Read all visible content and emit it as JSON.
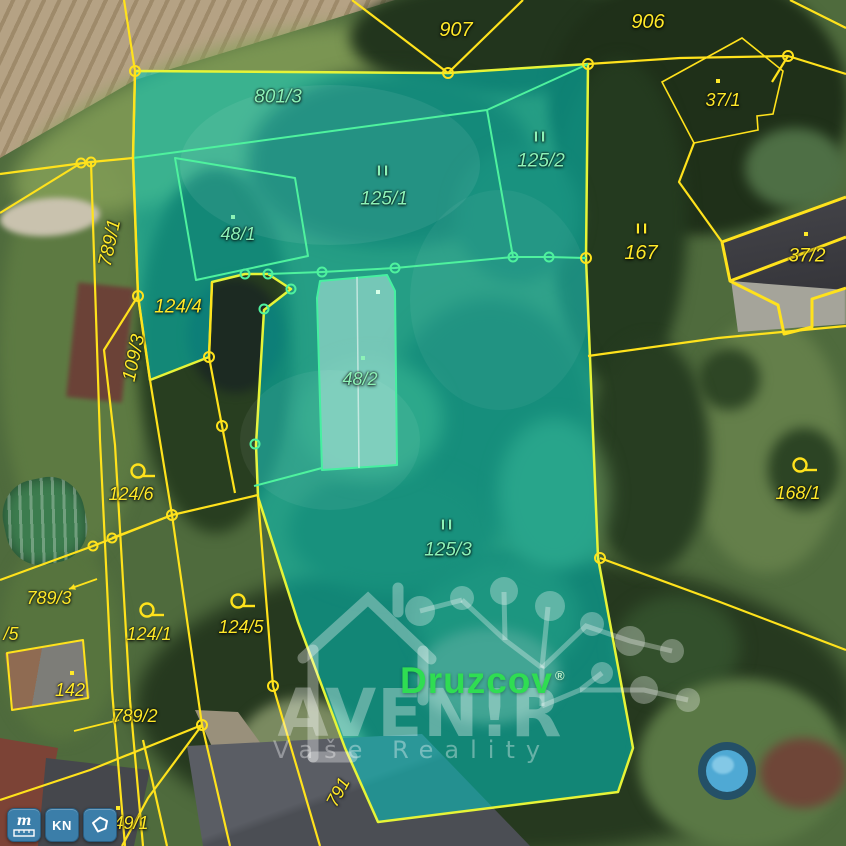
{
  "map": {
    "colors": {
      "highlight_fill": "#00cec7",
      "highlight_border": "#e6f437",
      "cadastre_yellow": "#ffe21c",
      "inner_parcel_green": "#4ef29e",
      "label_yellow": "#ffe929",
      "label_green": "#8df2b7",
      "druzcov_green": "#2fdd52",
      "button_blue": "#3b7ea9"
    },
    "parcel_labels": [
      {
        "text": "907",
        "x": 456,
        "y": 30,
        "color": "yellow",
        "fs": 20
      },
      {
        "text": "906",
        "x": 648,
        "y": 22,
        "color": "yellow",
        "fs": 20
      },
      {
        "text": "37/1",
        "x": 723,
        "y": 100,
        "color": "yellow",
        "fs": 18
      },
      {
        "text": "II",
        "x": 643,
        "y": 229,
        "color": "yellow",
        "fs": 15,
        "marker": true
      },
      {
        "text": "167",
        "x": 641,
        "y": 253,
        "color": "yellow",
        "fs": 20
      },
      {
        "text": "37/2",
        "x": 807,
        "y": 256,
        "color": "yellow",
        "fs": 19
      },
      {
        "text": "168/1",
        "x": 798,
        "y": 493,
        "color": "yellow",
        "fs": 18
      },
      {
        "text": "789/1",
        "x": 110,
        "y": 243,
        "color": "yellow",
        "fs": 19,
        "rot": -78
      },
      {
        "text": "109/3",
        "x": 134,
        "y": 358,
        "color": "yellow",
        "fs": 19,
        "rot": -78
      },
      {
        "text": "124/4",
        "x": 178,
        "y": 307,
        "color": "yellow",
        "fs": 19
      },
      {
        "text": "124/6",
        "x": 131,
        "y": 494,
        "color": "yellow",
        "fs": 18
      },
      {
        "text": "789/3",
        "x": 49,
        "y": 598,
        "color": "yellow",
        "fs": 18
      },
      {
        "text": "/5",
        "x": 11,
        "y": 634,
        "color": "yellow",
        "fs": 18
      },
      {
        "text": "124/1",
        "x": 149,
        "y": 634,
        "color": "yellow",
        "fs": 18
      },
      {
        "text": "142",
        "x": 70,
        "y": 690,
        "color": "yellow",
        "fs": 18
      },
      {
        "text": "789/2",
        "x": 135,
        "y": 716,
        "color": "yellow",
        "fs": 18
      },
      {
        "text": "124/5",
        "x": 241,
        "y": 627,
        "color": "yellow",
        "fs": 18
      },
      {
        "text": "791",
        "x": 338,
        "y": 792,
        "color": "yellow",
        "fs": 18,
        "rot": -62
      },
      {
        "text": "49/1",
        "x": 131,
        "y": 823,
        "color": "yellow",
        "fs": 18
      },
      {
        "text": "801/3",
        "x": 278,
        "y": 97,
        "color": "green",
        "fs": 19
      },
      {
        "text": "II",
        "x": 384,
        "y": 171,
        "color": "green",
        "fs": 15,
        "marker": true
      },
      {
        "text": "125/1",
        "x": 384,
        "y": 199,
        "color": "green",
        "fs": 19
      },
      {
        "text": "II",
        "x": 541,
        "y": 137,
        "color": "green",
        "fs": 15,
        "marker": true
      },
      {
        "text": "125/2",
        "x": 541,
        "y": 161,
        "color": "green",
        "fs": 19
      },
      {
        "text": "48/1",
        "x": 238,
        "y": 234,
        "color": "green",
        "fs": 18
      },
      {
        "text": "48/2",
        "x": 360,
        "y": 379,
        "color": "green",
        "fs": 18
      },
      {
        "text": "II",
        "x": 448,
        "y": 525,
        "color": "green",
        "fs": 15,
        "marker": true
      },
      {
        "text": "125/3",
        "x": 448,
        "y": 550,
        "color": "green",
        "fs": 19
      }
    ],
    "symbols": {
      "omegas": [
        {
          "x": 138,
          "y": 471
        },
        {
          "x": 147,
          "y": 610
        },
        {
          "x": 238,
          "y": 601
        },
        {
          "x": 800,
          "y": 465
        }
      ],
      "dots": [
        {
          "x": 72,
          "y": 673,
          "c": "#ffe929"
        },
        {
          "x": 118,
          "y": 808,
          "c": "#ffe929"
        },
        {
          "x": 718,
          "y": 81,
          "c": "#ffe929"
        },
        {
          "x": 806,
          "y": 234,
          "c": "#ffe929"
        },
        {
          "x": 233,
          "y": 217,
          "c": "#8df2b7"
        },
        {
          "x": 363,
          "y": 358,
          "c": "#8df2b7"
        },
        {
          "x": 378,
          "y": 292,
          "c": "#d9ffe9"
        }
      ],
      "arrows": [
        {
          "x1": 97,
          "y1": 579,
          "x2": 69,
          "y2": 589
        },
        {
          "x1": 74,
          "y1": 731,
          "x2": 119,
          "y2": 720
        }
      ]
    },
    "watermark": {
      "brand": "AVEN!R",
      "tagline": "Vaše Reality",
      "place_label": "Druzcov",
      "registered": "®"
    },
    "controls": {
      "buttons": [
        {
          "id": "measure",
          "label": "m"
        },
        {
          "id": "kn",
          "label": "KN"
        },
        {
          "id": "area",
          "label": ""
        }
      ]
    }
  }
}
